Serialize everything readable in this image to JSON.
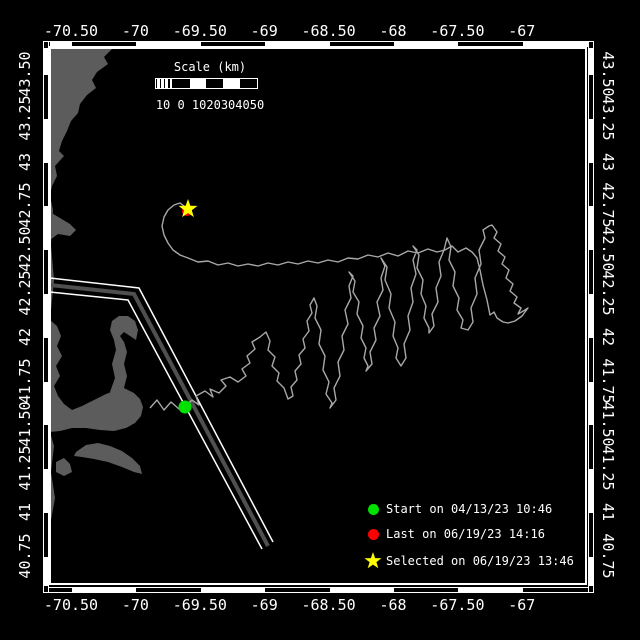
{
  "window": {
    "background": "#000000",
    "width": 640,
    "height": 640
  },
  "colors": {
    "frame": "#ffffff",
    "land": "#5c5c5c",
    "track": "#a8a8a8",
    "lane_median": "#4f4f4f",
    "lane_edge": "#ffffff",
    "start_marker": "#00e100",
    "last_marker": "#ff0000",
    "selected_marker": "#ffff00"
  },
  "map": {
    "axes": {
      "lon_labels": [
        "-70.50",
        "-70",
        "-69.50",
        "-69",
        "-68.50",
        "-68",
        "-67.50",
        "-67"
      ],
      "lat_labels": [
        "43.50",
        "43.25",
        "43",
        "42.75",
        "42.50",
        "42.25",
        "42",
        "41.75",
        "41.50",
        "41.25",
        "41",
        "40.75"
      ]
    },
    "markers": {
      "start": {
        "x": 185,
        "y": 407
      },
      "last": {
        "x": 187,
        "y": 211
      },
      "selected": {
        "x": 188,
        "y": 209
      }
    },
    "lane": {
      "median": [
        [
          50,
          285
        ],
        [
          134,
          294
        ],
        [
          268,
          546
        ]
      ],
      "edge_a": [
        [
          50,
          278
        ],
        [
          139,
          288
        ],
        [
          273,
          542
        ]
      ],
      "edge_b": [
        [
          50,
          292
        ],
        [
          128,
          300
        ],
        [
          262,
          549
        ]
      ]
    },
    "land_polygons": [
      [
        [
          50,
          48
        ],
        [
          113,
          48
        ],
        [
          104,
          57
        ],
        [
          108,
          64
        ],
        [
          97,
          72
        ],
        [
          92,
          80
        ],
        [
          96,
          88
        ],
        [
          87,
          95
        ],
        [
          80,
          104
        ],
        [
          78,
          113
        ],
        [
          71,
          121
        ],
        [
          67,
          131
        ],
        [
          62,
          141
        ],
        [
          59,
          151
        ],
        [
          64,
          156
        ],
        [
          55,
          166
        ],
        [
          57,
          176
        ],
        [
          52,
          186
        ],
        [
          50,
          196
        ]
      ],
      [
        [
          50,
          212
        ],
        [
          60,
          218
        ],
        [
          70,
          224
        ],
        [
          76,
          230
        ],
        [
          70,
          236
        ],
        [
          58,
          234
        ],
        [
          50,
          240
        ]
      ],
      [
        [
          50,
          196
        ],
        [
          53,
          210
        ],
        [
          51,
          245
        ],
        [
          54,
          280
        ],
        [
          51,
          310
        ],
        [
          50,
          320
        ]
      ],
      [
        [
          50,
          320
        ],
        [
          57,
          326
        ],
        [
          61,
          336
        ],
        [
          57,
          346
        ],
        [
          62,
          356
        ],
        [
          56,
          366
        ],
        [
          60,
          376
        ],
        [
          54,
          386
        ],
        [
          58,
          396
        ],
        [
          64,
          404
        ],
        [
          72,
          410
        ],
        [
          82,
          406
        ],
        [
          94,
          400
        ],
        [
          106,
          394
        ],
        [
          116,
          390
        ],
        [
          126,
          389
        ],
        [
          134,
          393
        ],
        [
          140,
          399
        ],
        [
          143,
          407
        ],
        [
          141,
          416
        ],
        [
          135,
          423
        ],
        [
          126,
          428
        ],
        [
          114,
          431
        ],
        [
          100,
          430
        ],
        [
          86,
          428
        ],
        [
          72,
          428
        ],
        [
          60,
          431
        ],
        [
          50,
          432
        ]
      ],
      [
        [
          110,
          392
        ],
        [
          115,
          378
        ],
        [
          112,
          364
        ],
        [
          116,
          350
        ],
        [
          114,
          340
        ],
        [
          110,
          330
        ],
        [
          112,
          321
        ],
        [
          119,
          316
        ],
        [
          128,
          316
        ],
        [
          135,
          321
        ],
        [
          138,
          330
        ],
        [
          136,
          340
        ],
        [
          130,
          336
        ],
        [
          124,
          332
        ],
        [
          120,
          336
        ],
        [
          124,
          342
        ],
        [
          127,
          352
        ],
        [
          124,
          364
        ],
        [
          127,
          376
        ],
        [
          124,
          388
        ],
        [
          130,
          392
        ],
        [
          136,
          397
        ],
        [
          130,
          401
        ],
        [
          122,
          399
        ],
        [
          116,
          396
        ]
      ],
      [
        [
          76,
          452
        ],
        [
          86,
          445
        ],
        [
          98,
          443
        ],
        [
          110,
          446
        ],
        [
          122,
          451
        ],
        [
          132,
          458
        ],
        [
          140,
          466
        ],
        [
          142,
          474
        ],
        [
          134,
          472
        ],
        [
          122,
          467
        ],
        [
          108,
          462
        ],
        [
          94,
          459
        ],
        [
          82,
          457
        ],
        [
          74,
          456
        ]
      ],
      [
        [
          56,
          462
        ],
        [
          64,
          458
        ],
        [
          70,
          464
        ],
        [
          72,
          472
        ],
        [
          64,
          476
        ],
        [
          56,
          472
        ]
      ],
      [
        [
          50,
          432
        ],
        [
          54,
          446
        ],
        [
          51,
          472
        ],
        [
          55,
          498
        ],
        [
          51,
          520
        ],
        [
          50,
          524
        ]
      ]
    ],
    "track_points": [
      [
        150,
        408
      ],
      [
        157,
        400
      ],
      [
        164,
        410
      ],
      [
        171,
        402
      ],
      [
        179,
        409
      ],
      [
        185,
        407
      ],
      [
        192,
        400
      ],
      [
        199,
        405
      ],
      [
        196,
        396
      ],
      [
        205,
        391
      ],
      [
        213,
        397
      ],
      [
        210,
        389
      ],
      [
        219,
        393
      ],
      [
        226,
        386
      ],
      [
        221,
        380
      ],
      [
        230,
        377
      ],
      [
        238,
        382
      ],
      [
        246,
        376
      ],
      [
        242,
        369
      ],
      [
        250,
        363
      ],
      [
        247,
        356
      ],
      [
        255,
        349
      ],
      [
        252,
        342
      ],
      [
        260,
        337
      ],
      [
        266,
        332
      ],
      [
        270,
        341
      ],
      [
        268,
        350
      ],
      [
        275,
        357
      ],
      [
        272,
        366
      ],
      [
        279,
        373
      ],
      [
        277,
        381
      ],
      [
        284,
        388
      ],
      [
        288,
        399
      ],
      [
        293,
        396
      ],
      [
        291,
        387
      ],
      [
        297,
        380
      ],
      [
        295,
        371
      ],
      [
        301,
        364
      ],
      [
        299,
        355
      ],
      [
        305,
        348
      ],
      [
        303,
        339
      ],
      [
        309,
        331
      ],
      [
        307,
        321
      ],
      [
        312,
        313
      ],
      [
        310,
        305
      ],
      [
        314,
        298
      ],
      [
        317,
        306
      ],
      [
        315,
        318
      ],
      [
        321,
        330
      ],
      [
        319,
        344
      ],
      [
        325,
        356
      ],
      [
        323,
        370
      ],
      [
        329,
        382
      ],
      [
        326,
        394
      ],
      [
        332,
        403
      ],
      [
        330,
        408
      ],
      [
        336,
        400
      ],
      [
        334,
        388
      ],
      [
        340,
        376
      ],
      [
        338,
        362
      ],
      [
        344,
        350
      ],
      [
        342,
        336
      ],
      [
        348,
        324
      ],
      [
        345,
        310
      ],
      [
        351,
        298
      ],
      [
        349,
        286
      ],
      [
        353,
        276
      ],
      [
        349,
        272
      ],
      [
        355,
        281
      ],
      [
        353,
        292
      ],
      [
        359,
        302
      ],
      [
        357,
        314
      ],
      [
        363,
        326
      ],
      [
        361,
        338
      ],
      [
        366,
        348
      ],
      [
        364,
        358
      ],
      [
        368,
        366
      ],
      [
        366,
        371
      ],
      [
        372,
        364
      ],
      [
        370,
        352
      ],
      [
        376,
        340
      ],
      [
        374,
        328
      ],
      [
        380,
        316
      ],
      [
        377,
        302
      ],
      [
        383,
        290
      ],
      [
        381,
        278
      ],
      [
        385,
        266
      ],
      [
        381,
        258
      ],
      [
        387,
        267
      ],
      [
        385,
        280
      ],
      [
        391,
        294
      ],
      [
        389,
        308
      ],
      [
        395,
        322
      ],
      [
        393,
        336
      ],
      [
        398,
        348
      ],
      [
        396,
        358
      ],
      [
        401,
        366
      ],
      [
        406,
        358
      ],
      [
        404,
        344
      ],
      [
        410,
        330
      ],
      [
        408,
        316
      ],
      [
        413,
        302
      ],
      [
        411,
        288
      ],
      [
        416,
        274
      ],
      [
        413,
        260
      ],
      [
        417,
        250
      ],
      [
        413,
        246
      ],
      [
        419,
        255
      ],
      [
        417,
        268
      ],
      [
        423,
        280
      ],
      [
        421,
        294
      ],
      [
        426,
        306
      ],
      [
        424,
        318
      ],
      [
        429,
        328
      ],
      [
        429,
        333
      ],
      [
        434,
        326
      ],
      [
        432,
        314
      ],
      [
        438,
        302
      ],
      [
        436,
        288
      ],
      [
        441,
        276
      ],
      [
        439,
        262
      ],
      [
        444,
        250
      ],
      [
        447,
        238
      ],
      [
        451,
        247
      ],
      [
        449,
        260
      ],
      [
        455,
        272
      ],
      [
        453,
        286
      ],
      [
        459,
        298
      ],
      [
        457,
        310
      ],
      [
        463,
        320
      ],
      [
        461,
        328
      ],
      [
        468,
        330
      ],
      [
        473,
        322
      ],
      [
        471,
        308
      ],
      [
        477,
        294
      ],
      [
        475,
        278
      ],
      [
        481,
        264
      ],
      [
        479,
        250
      ],
      [
        485,
        238
      ],
      [
        483,
        230
      ],
      [
        489,
        226
      ],
      [
        492,
        225
      ],
      [
        497,
        232
      ],
      [
        494,
        238
      ],
      [
        501,
        244
      ],
      [
        498,
        251
      ],
      [
        505,
        257
      ],
      [
        502,
        264
      ],
      [
        509,
        270
      ],
      [
        506,
        278
      ],
      [
        513,
        284
      ],
      [
        510,
        291
      ],
      [
        517,
        297
      ],
      [
        514,
        303
      ],
      [
        521,
        308
      ],
      [
        518,
        314
      ],
      [
        525,
        310
      ],
      [
        528,
        308
      ],
      [
        522,
        316
      ],
      [
        515,
        321
      ],
      [
        508,
        323
      ],
      [
        503,
        322
      ],
      [
        497,
        318
      ],
      [
        494,
        312
      ],
      [
        490,
        315
      ],
      [
        487,
        300
      ],
      [
        483,
        285
      ],
      [
        480,
        270
      ],
      [
        477,
        258
      ],
      [
        472,
        252
      ],
      [
        466,
        248
      ],
      [
        458,
        252
      ],
      [
        452,
        246
      ],
      [
        445,
        250
      ],
      [
        437,
        252
      ],
      [
        428,
        249
      ],
      [
        418,
        253
      ],
      [
        408,
        251
      ],
      [
        398,
        256
      ],
      [
        388,
        253
      ],
      [
        378,
        257
      ],
      [
        368,
        255
      ],
      [
        358,
        259
      ],
      [
        348,
        258
      ],
      [
        338,
        262
      ],
      [
        328,
        260
      ],
      [
        318,
        263
      ],
      [
        308,
        261
      ],
      [
        298,
        264
      ],
      [
        288,
        262
      ],
      [
        278,
        265
      ],
      [
        268,
        263
      ],
      [
        258,
        266
      ],
      [
        248,
        264
      ],
      [
        238,
        266
      ],
      [
        228,
        263
      ],
      [
        218,
        265
      ],
      [
        208,
        261
      ],
      [
        198,
        262
      ],
      [
        188,
        258
      ],
      [
        180,
        255
      ],
      [
        173,
        250
      ],
      [
        168,
        243
      ],
      [
        164,
        235
      ],
      [
        162,
        226
      ],
      [
        164,
        217
      ],
      [
        168,
        210
      ],
      [
        174,
        205
      ],
      [
        180,
        203
      ],
      [
        184,
        206
      ],
      [
        188,
        209
      ]
    ]
  },
  "scalebar": {
    "title": "Scale (km)",
    "tick_text": "10 0 1020304050"
  },
  "legend": {
    "items": [
      {
        "marker": "circle",
        "color": "#00e100",
        "label": "Start on 04/13/23 10:46"
      },
      {
        "marker": "circle",
        "color": "#ff0000",
        "label": "Last on 06/19/23 14:16"
      },
      {
        "marker": "star",
        "color": "#ffff00",
        "label": "Selected on 06/19/23 13:46"
      }
    ]
  }
}
